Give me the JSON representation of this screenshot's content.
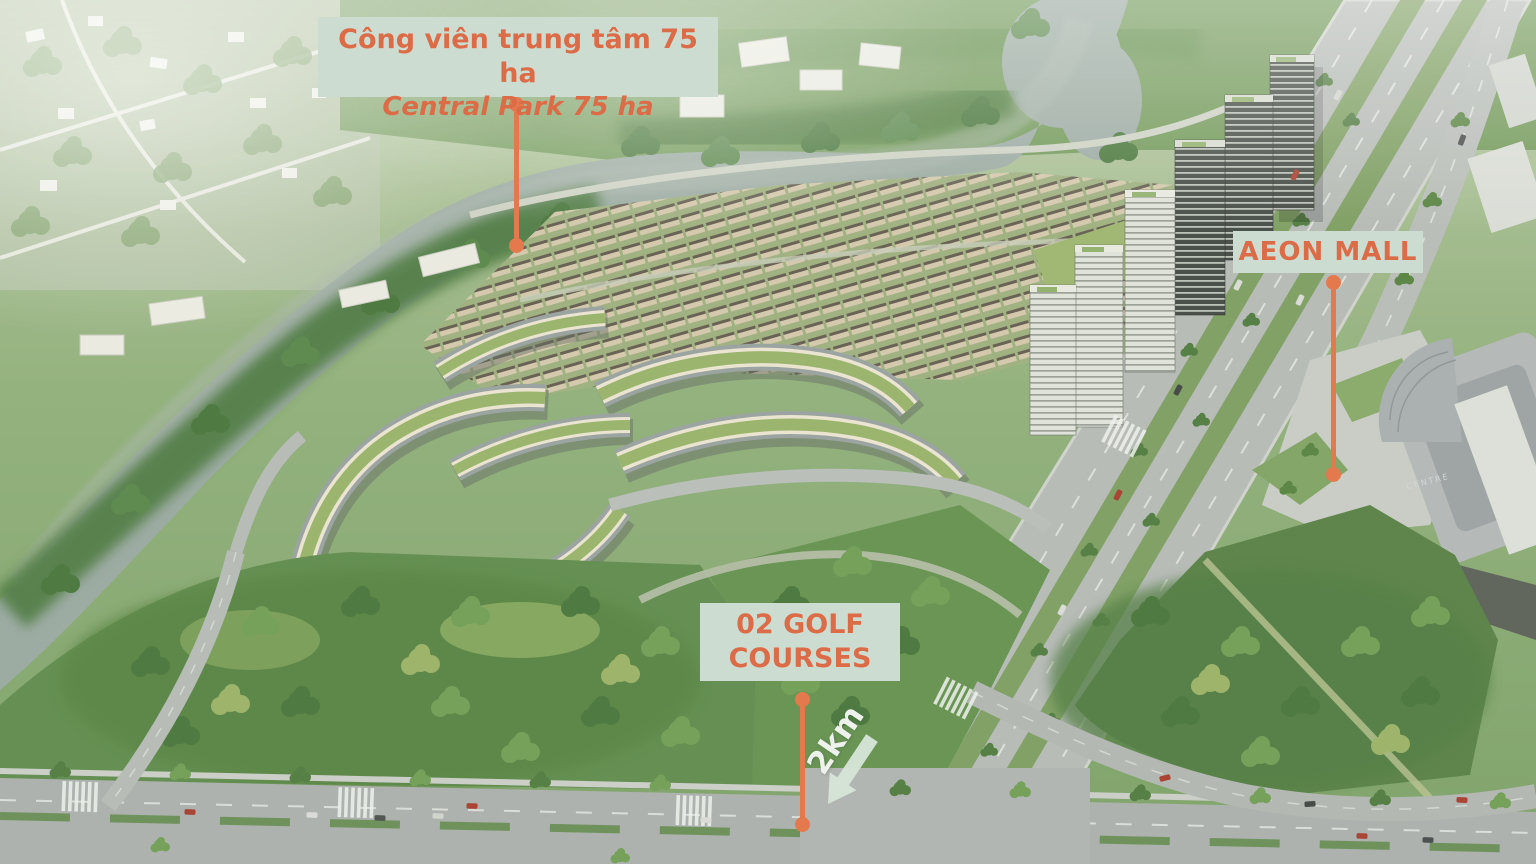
{
  "annotations": {
    "central_park": {
      "line1": "Công viên trung tâm 75 ha",
      "line2": "Central Park 75 ha"
    },
    "aeon_mall": {
      "label": "AEON MALL"
    },
    "golf_courses": {
      "line1": "02 GOLF",
      "line2": "COURSES"
    },
    "distance": {
      "label": "2km"
    },
    "mall_roof_text": "CENTRE"
  },
  "colors": {
    "label_bg": "#cddcd0",
    "label_text": "#dc6b47",
    "pointer_line": "#e5794e",
    "arrow_fill": "#d7e6d9",
    "distance_text": "#edf3ec",
    "river": "#98a8a1",
    "road": "#b4b9b6",
    "green_roof": "#96b269"
  }
}
